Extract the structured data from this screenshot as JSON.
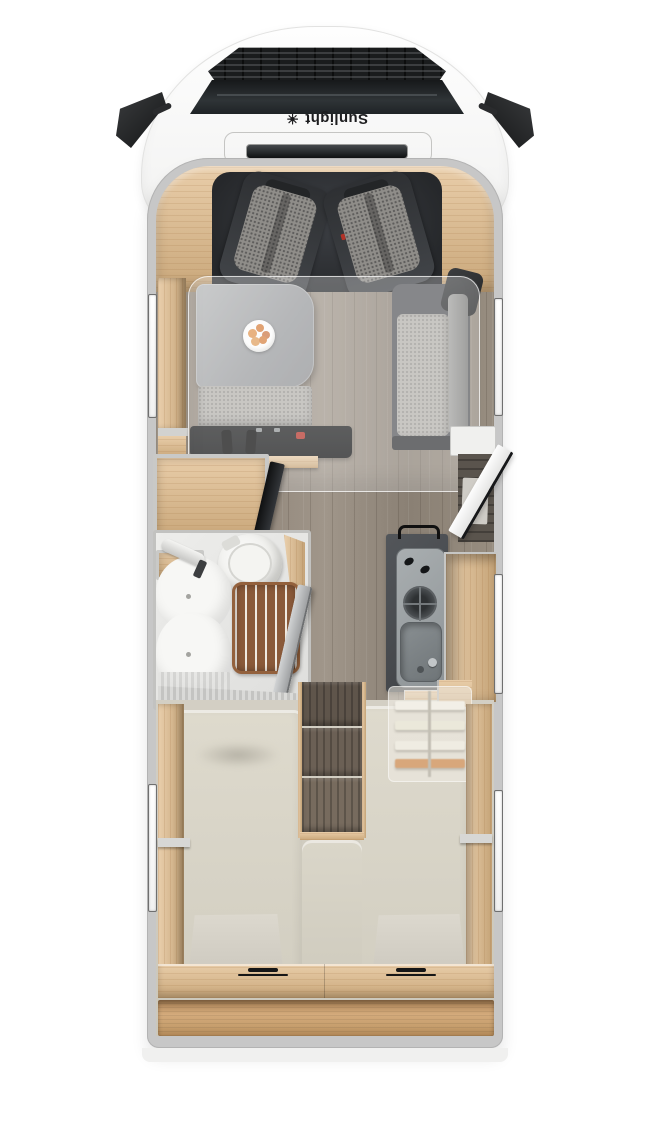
{
  "brand": {
    "label": "Sunlight",
    "logo_glyph": "☀"
  },
  "palette": {
    "cab_white": "#f7f7f6",
    "wall_gray": "#c7c7c7",
    "oak_wood": "#e0ba88",
    "walnut_steps": "#6b6055",
    "floor_wood": "#978d80",
    "seat_upholstery": "#8f8d89",
    "cushion_light": "#b5b3ae",
    "mattress_cream": "#d8d4c8",
    "kitchen_counter_dark": "#45484c",
    "steel": "#9aa0a3",
    "teak_grate": "#8a5a3a",
    "fixture_white": "#f6f6f4",
    "tv_black": "#232528",
    "seatbelt_red": "#b33227"
  },
  "areas": {
    "cab": "driver-cab-with-two-swivel-seats",
    "dinette": "dinette-table-with-bench",
    "drop_down_bed": "translucent-drop-down-bed",
    "sofa": "side-bench-sofa",
    "tv": "swivel-tv-panel",
    "wardrobe": "wardrobe-cabinet",
    "bathroom": "bathroom-toilet-sink-shower",
    "kitchen": "kitchen-hob-and-sink",
    "entry": "open-entry-door",
    "bedroom": "twin-single-beds-with-center-steps",
    "storage": "rear-storage-shelf-with-hatch-handles"
  }
}
